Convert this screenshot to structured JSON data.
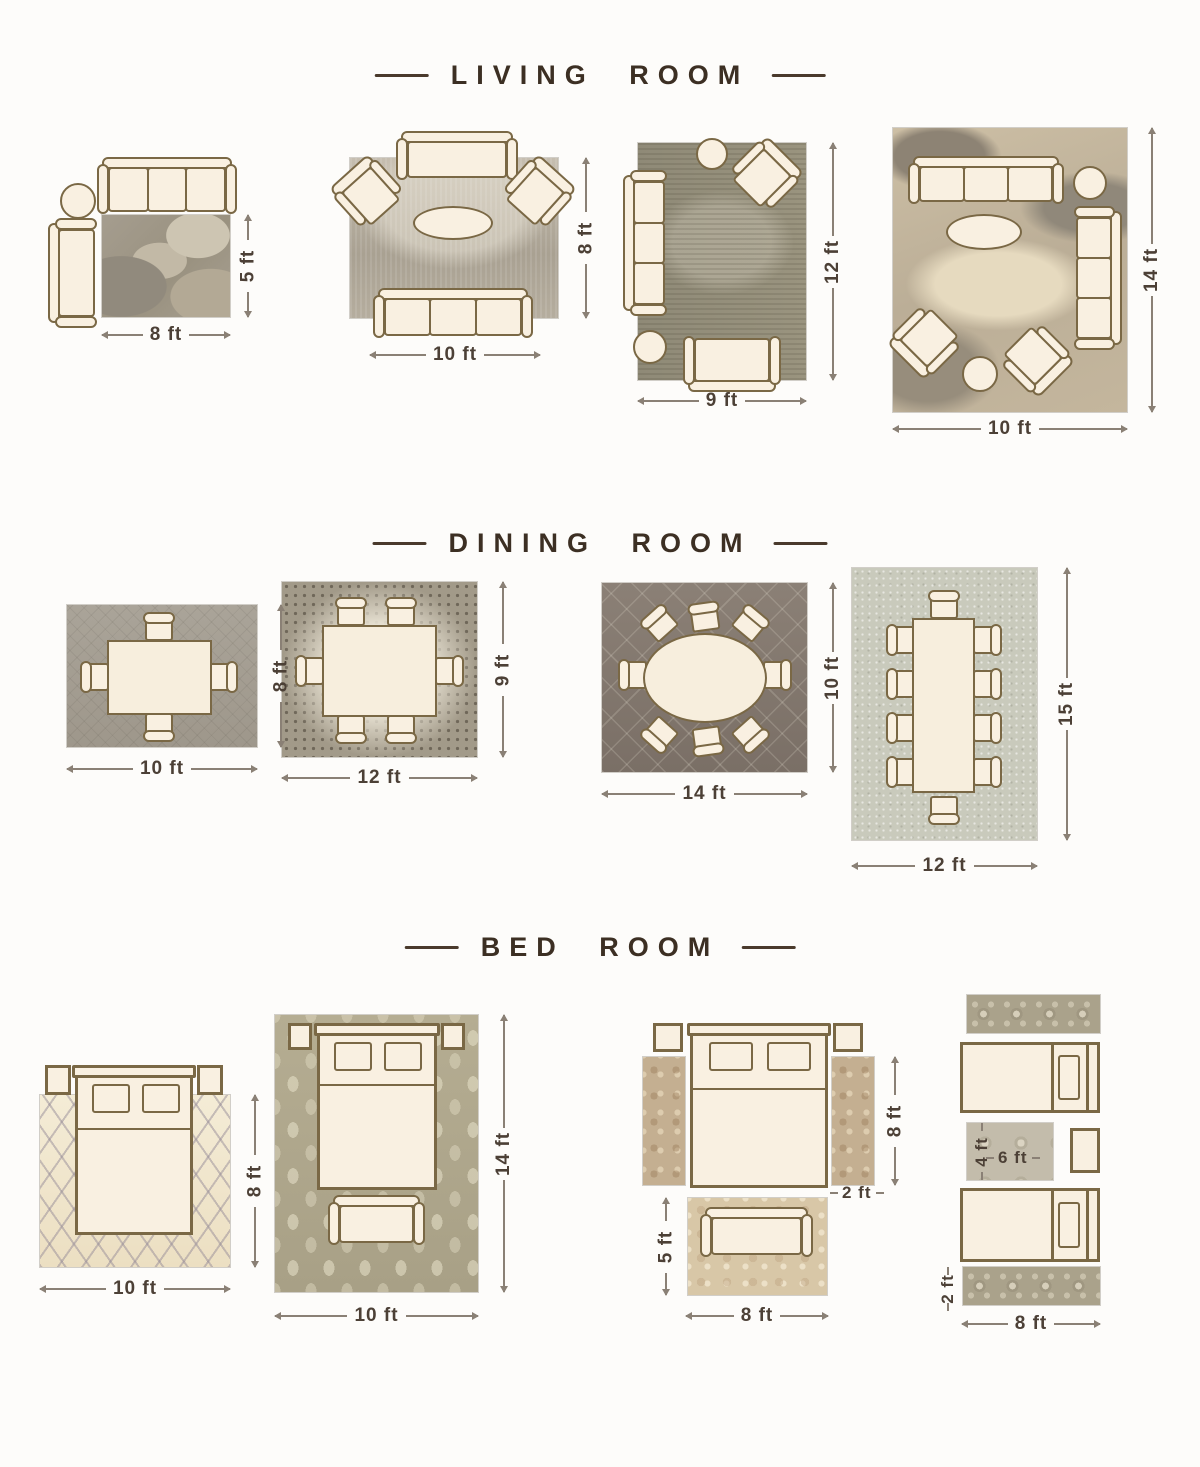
{
  "titles": {
    "living": "LIVING ROOM",
    "dining": "DINING ROOM",
    "bed": "BED ROOM"
  },
  "living_room": {
    "l1": {
      "w": "8 ft",
      "h": "5 ft"
    },
    "l2": {
      "w": "10 ft",
      "h": "8 ft"
    },
    "l3": {
      "w": "9 ft",
      "h": "12 ft"
    },
    "l4": {
      "w": "10 ft",
      "h": "14 ft"
    }
  },
  "dining_room": {
    "l1": {
      "w": "10 ft",
      "h": "8 ft"
    },
    "l2": {
      "w": "12 ft",
      "h": "9 ft"
    },
    "l3": {
      "w": "14 ft",
      "h": "10 ft"
    },
    "l4": {
      "w": "12 ft",
      "h": "15 ft"
    }
  },
  "bed_room": {
    "l1": {
      "w": "10 ft",
      "h": "8 ft"
    },
    "l2": {
      "w": "10 ft",
      "h": "14 ft"
    },
    "l3": {
      "side_h": "8 ft",
      "runner_w": "2 ft",
      "foot_h": "5 ft",
      "foot_w": "8 ft"
    },
    "l4": {
      "mid_h": "4 ft",
      "mid_w": "6 ft",
      "runner_h": "2 ft",
      "w": "8 ft"
    }
  },
  "colors": {
    "background": "#fdfcfa",
    "furniture_outline": "#7a6845",
    "furniture_fill": "#f9f0e1",
    "title_text": "#3c2f23",
    "dimension_text": "#4c4036"
  }
}
